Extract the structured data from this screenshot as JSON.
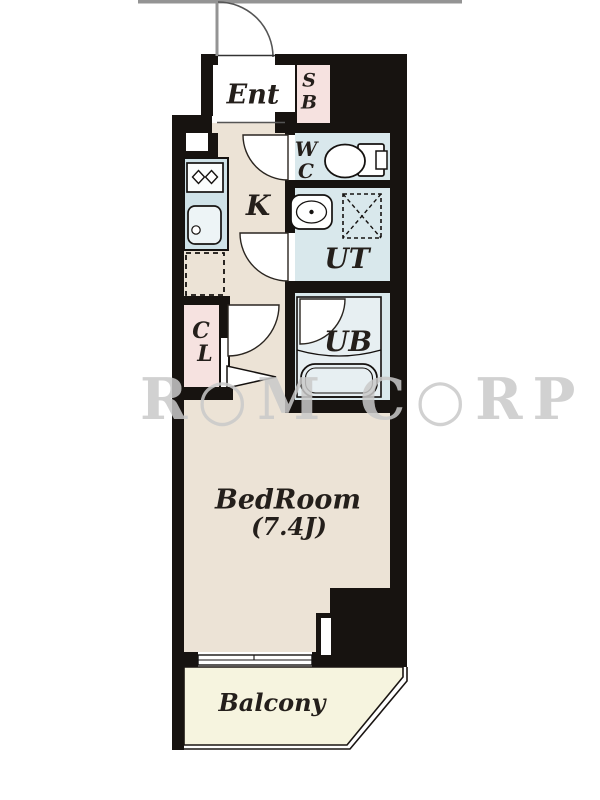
{
  "plan": {
    "title": "apartment-floor-plan",
    "watermark": "R○M C○RP",
    "rooms": {
      "ent": {
        "label": "Ent"
      },
      "sb": {
        "line1": "S",
        "line2": "B"
      },
      "wc": {
        "line1": "W",
        "line2": "C"
      },
      "kitchen": {
        "label": "K"
      },
      "ut": {
        "label": "UT"
      },
      "cl": {
        "line1": "C",
        "line2": "L"
      },
      "ub": {
        "label": "UB"
      },
      "bedroom": {
        "label": "BedRoom",
        "size": "(7.4J)"
      },
      "balcony": {
        "label": "Balcony"
      }
    },
    "colors": {
      "wall": "#171310",
      "floor_beige": "#ece3d6",
      "floor_pink": "#f6e2e0",
      "floor_blue": "#d9e8ec",
      "balcony_cream": "#f6f4df",
      "line_gray": "#949494"
    }
  }
}
